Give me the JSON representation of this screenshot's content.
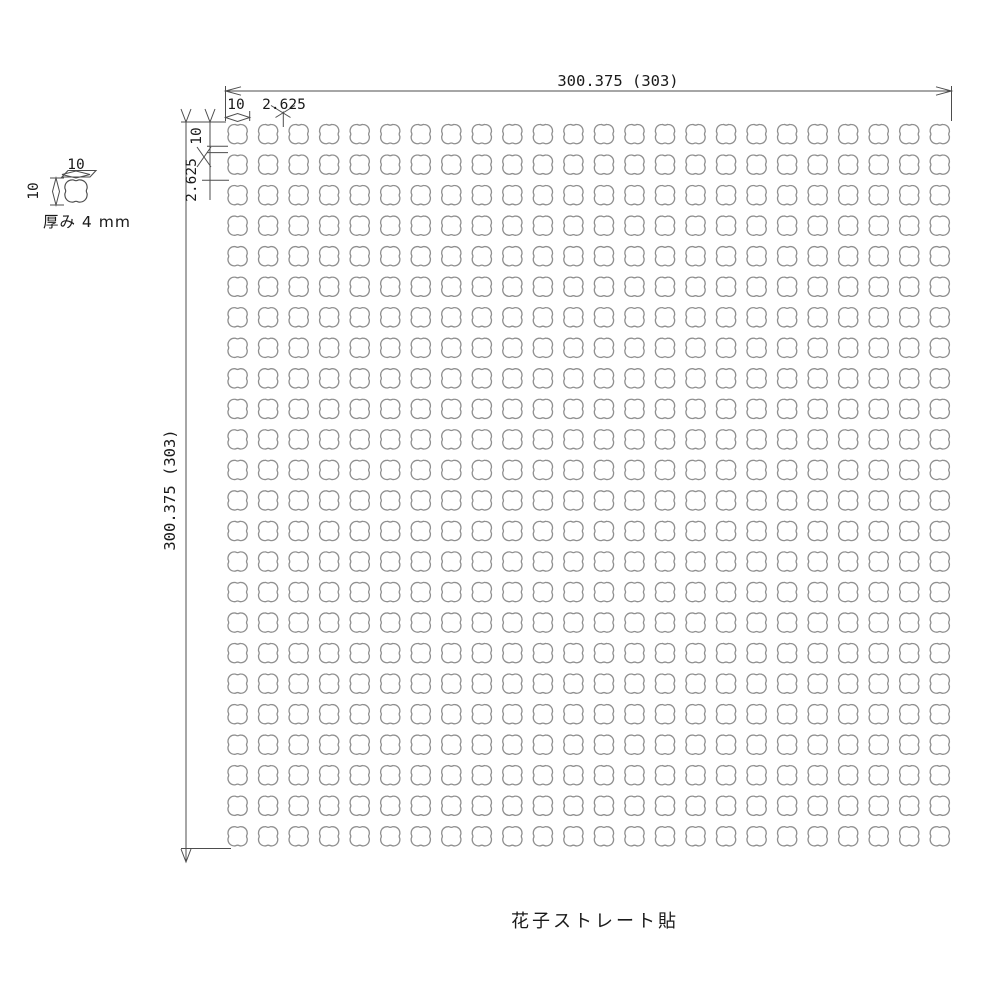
{
  "drawing": {
    "caption": "花子ストレート貼",
    "sheet": {
      "width_label": "300.375 (303)",
      "height_label": "300.375 (303)",
      "tile_width_label": "10",
      "joint_width_label": "2.625",
      "tile_height_label": "10",
      "joint_height_label": "2.625",
      "grid": {
        "cols": 24,
        "rows": 24
      }
    },
    "tile_detail": {
      "width_label": "10",
      "height_label": "10",
      "thickness_label": "厚み 4 mm"
    },
    "colors": {
      "background": "#ffffff",
      "tile_stroke": "#8f8f8f",
      "dimension_line": "#4d4d4d",
      "text": "#1a1a1a"
    }
  }
}
